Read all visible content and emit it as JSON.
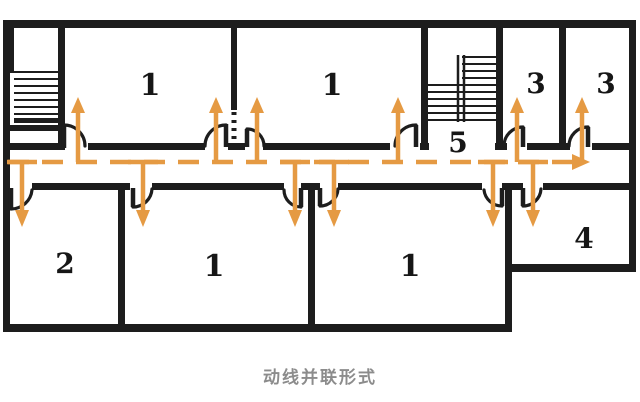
{
  "diagram": {
    "caption": "动线并联形式",
    "rooms": [
      {
        "id": "room-1-upper-left",
        "label": "1"
      },
      {
        "id": "room-1-upper-right",
        "label": "1"
      },
      {
        "id": "stairwell-5",
        "label": "5"
      },
      {
        "id": "room-3-left",
        "label": "3"
      },
      {
        "id": "room-3-right",
        "label": "3"
      },
      {
        "id": "room-2",
        "label": "2"
      },
      {
        "id": "room-1-lower-middle",
        "label": "1"
      },
      {
        "id": "room-1-lower-right",
        "label": "1"
      },
      {
        "id": "room-4",
        "label": "4"
      }
    ],
    "colors": {
      "wall": "#1d1d1d",
      "accent": "#e59a43",
      "caption": "#8c8c8c",
      "background": "#ffffff"
    }
  }
}
